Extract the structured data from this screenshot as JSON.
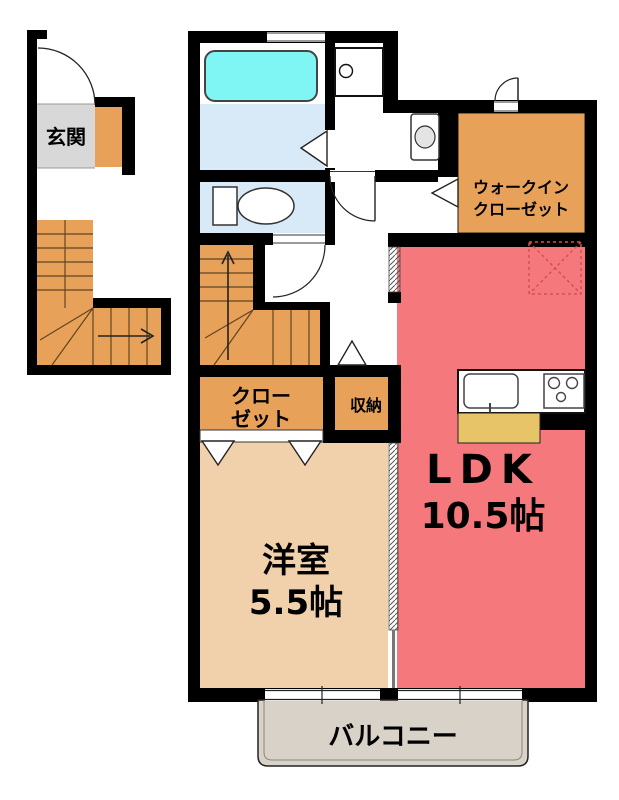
{
  "floorplan": {
    "labels": {
      "entrance": "玄関",
      "walk_in_closet_line1": "ウォークイン",
      "walk_in_closet_line2": "クローゼット",
      "closet_line1": "クロー",
      "closet_line2": "ゼット",
      "storage": "収納",
      "western_room_name": "洋室",
      "western_room_size": "5.5帖",
      "ldk_name": "LDK",
      "ldk_size": "10.5帖",
      "balcony": "バルコニー"
    },
    "colors": {
      "wall": "#000000",
      "stairs_orange": "#E8A159",
      "ldk_pink": "#F5797C",
      "room_beige": "#F1D0AC",
      "bathtub_cyan": "#7FF6F3",
      "water_blue": "#D8EAF8",
      "entrance_gray": "#D8D8D8",
      "counter_yellow": "#E7C468",
      "balcony_gray": "#D8D2C8",
      "fridge_dashed_red": "#D94F4F",
      "white": "#FFFFFF"
    }
  }
}
